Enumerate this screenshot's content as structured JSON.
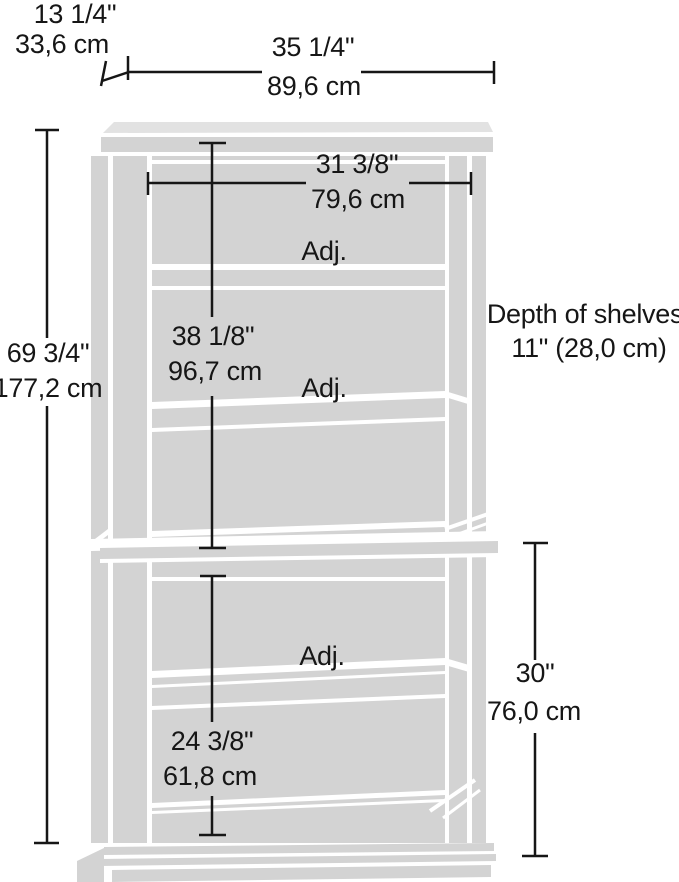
{
  "figure": {
    "kind": "product-dimension-diagram",
    "subject": "5-shelf bookcase line drawing",
    "shelf_label": "Adj.",
    "depth_note": {
      "line1": "Depth of shelves",
      "line2": "11\" (28,0 cm)"
    },
    "dimensions": {
      "top_depth": {
        "inches": "13 1/4\"",
        "cm": "33,6 cm"
      },
      "overall_width": {
        "inches": "35 1/4\"",
        "cm": "89,6 cm"
      },
      "interior_width": {
        "inches": "31 3/8\"",
        "cm": "79,6 cm"
      },
      "overall_height": {
        "inches": "69 3/4\"",
        "cm": "177,2 cm"
      },
      "upper_section_height": {
        "inches": "38 1/8\"",
        "cm": "96,7 cm"
      },
      "lower_interior_height": {
        "inches": "24 3/8\"",
        "cm": "61,8 cm"
      },
      "lower_section_height": {
        "inches": "30\"",
        "cm": "76,0 cm"
      }
    },
    "colors": {
      "background": "#ffffff",
      "furniture_fill": "#d3d3d3",
      "furniture_fill_light": "#e2e2e2",
      "dimension_line": "#161616"
    }
  }
}
